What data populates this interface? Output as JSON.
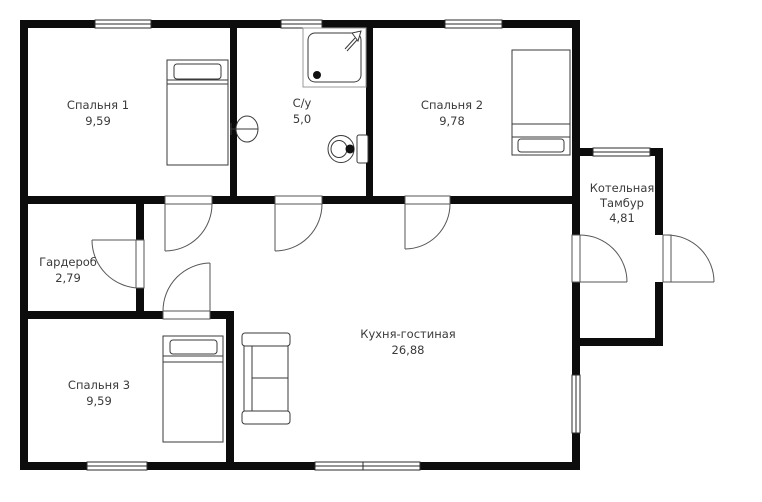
{
  "plan_title": "floor-plan",
  "rooms": {
    "bedroom1": {
      "label": "Спальня 1",
      "area": "9,59"
    },
    "bathroom": {
      "label": "С/у",
      "area": "5,0"
    },
    "bedroom2": {
      "label": "Спальня 2",
      "area": "9,78"
    },
    "boiler": {
      "label": "Котельная",
      "label2": "Тамбур",
      "area": "4,81"
    },
    "wardrobe": {
      "label": "Гардероб",
      "area": "2,79"
    },
    "kitchen": {
      "label": "Кухня-гостиная",
      "area": "26,88"
    },
    "bedroom3": {
      "label": "Спальня 3",
      "area": "9,59"
    }
  },
  "colors": {
    "wall": "#0c0c0c",
    "furniture_line": "#3a3a3a",
    "door_line": "#565656",
    "text": "#3a3a3a",
    "background": "#ffffff"
  }
}
